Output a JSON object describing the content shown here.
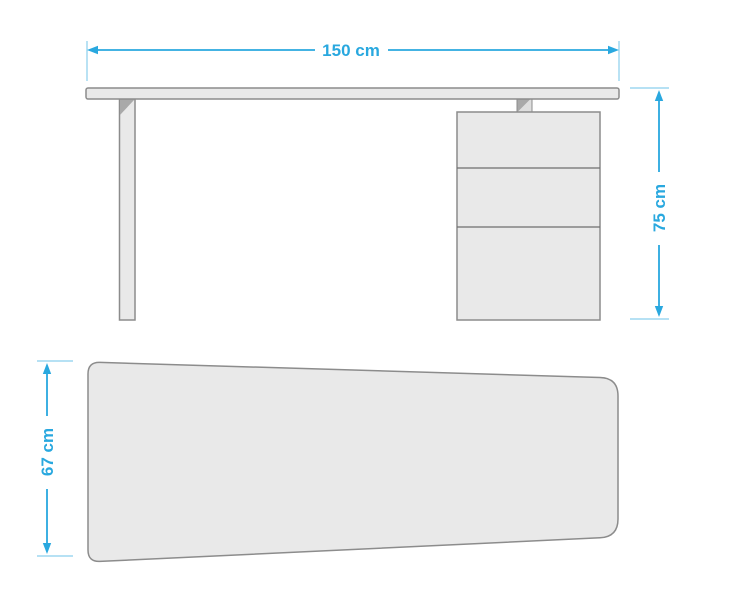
{
  "figure": {
    "type": "furniture-dimension-diagram",
    "subject": "desk with three-drawer pedestal",
    "views": {
      "front": {
        "name": "front-elevation",
        "width": {
          "value": 150,
          "unit": "cm",
          "label": "150 cm"
        },
        "height": {
          "value": 75,
          "unit": "cm",
          "label": "75 cm"
        },
        "drawer_count": 3,
        "parts": [
          "tabletop",
          "left-leg",
          "drawer-unit",
          "mounting-bracket"
        ]
      },
      "top": {
        "name": "top-view-desk-surface",
        "depth": {
          "value": 67,
          "unit": "cm",
          "label": "67 cm"
        },
        "shape": "rounded trapezoid, deeper on the left side"
      }
    },
    "colors": {
      "dimension_accent": "#29A8DF",
      "panel_fill": "#E9E9E9",
      "panel_stroke": "#8C8C8C",
      "shadow_gray": "#A9A9A9",
      "background": "#FFFFFF"
    }
  }
}
